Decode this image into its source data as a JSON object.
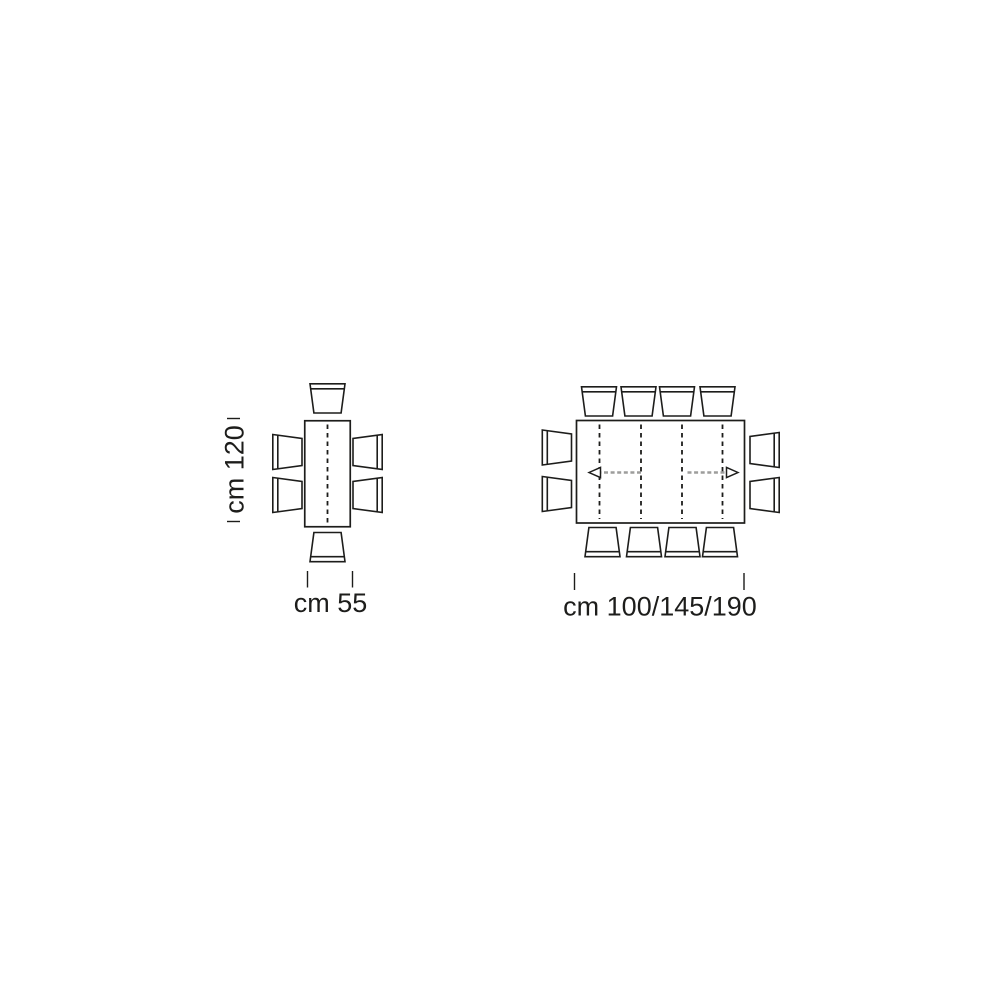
{
  "colors": {
    "background": "#ffffff",
    "line": "#1d1d1b",
    "arrow_gray": "#9d9d9c",
    "text": "#1d1d1b"
  },
  "left_diagram": {
    "length_label": "cm 120",
    "width_label": "cm 55",
    "chair_count": 6
  },
  "right_diagram": {
    "width_label": "cm 100/145/190",
    "chair_count": 12,
    "leaf_divider_count": 4,
    "extension_arrow_count": 2
  }
}
